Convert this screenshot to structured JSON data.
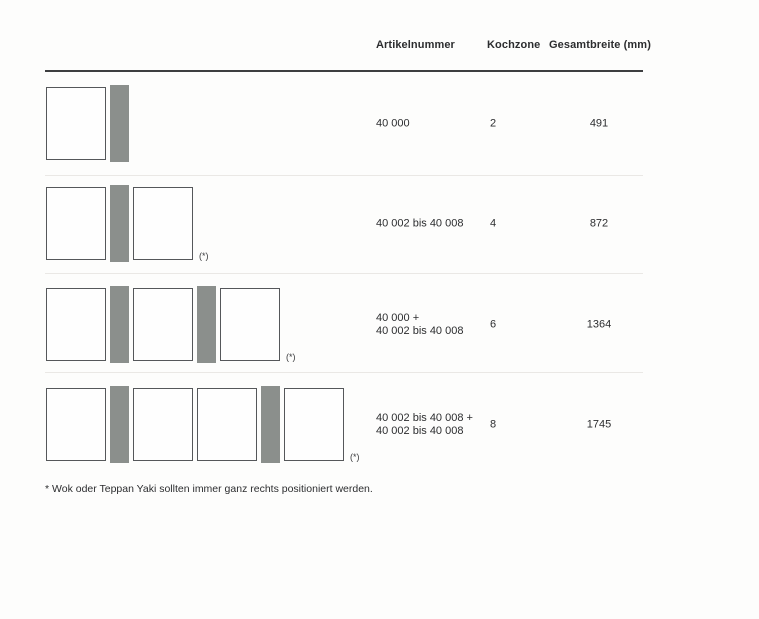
{
  "header": {
    "columns": [
      "Artikelnummer",
      "Kochzone",
      "Gesamtbreite (mm)"
    ]
  },
  "table": {
    "rows": [
      {
        "artikelnummer": [
          "40 000"
        ],
        "kochzone": "2",
        "gesamtbreite": "491",
        "modules": [
          "panel",
          "strip"
        ],
        "asterisk": false
      },
      {
        "artikelnummer": [
          "40 002 bis 40 008"
        ],
        "kochzone": "4",
        "gesamtbreite": "872",
        "modules": [
          "panel",
          "strip",
          "panel"
        ],
        "asterisk": true
      },
      {
        "artikelnummer": [
          "40 000 +",
          "40 002 bis 40 008"
        ],
        "kochzone": "6",
        "gesamtbreite": "1364",
        "modules": [
          "panel",
          "strip",
          "panel",
          "strip",
          "panel"
        ],
        "asterisk": true
      },
      {
        "artikelnummer": [
          "40 002 bis 40 008 +",
          "40 002 bis 40 008"
        ],
        "kochzone": "8",
        "gesamtbreite": "1745",
        "modules": [
          "panel",
          "strip",
          "panel",
          "panel",
          "strip",
          "panel"
        ],
        "asterisk": true
      }
    ]
  },
  "footnote_marker": "(*)",
  "footnote": "* Wok oder Teppan Yaki sollten immer ganz rechts positioniert werden.",
  "colors": {
    "strip_gray": "#8b8f8c",
    "panel_border": "#55575a",
    "header_rule": "#3d3e40",
    "separator": "#eae8e5",
    "text": "#2c2d2f"
  }
}
